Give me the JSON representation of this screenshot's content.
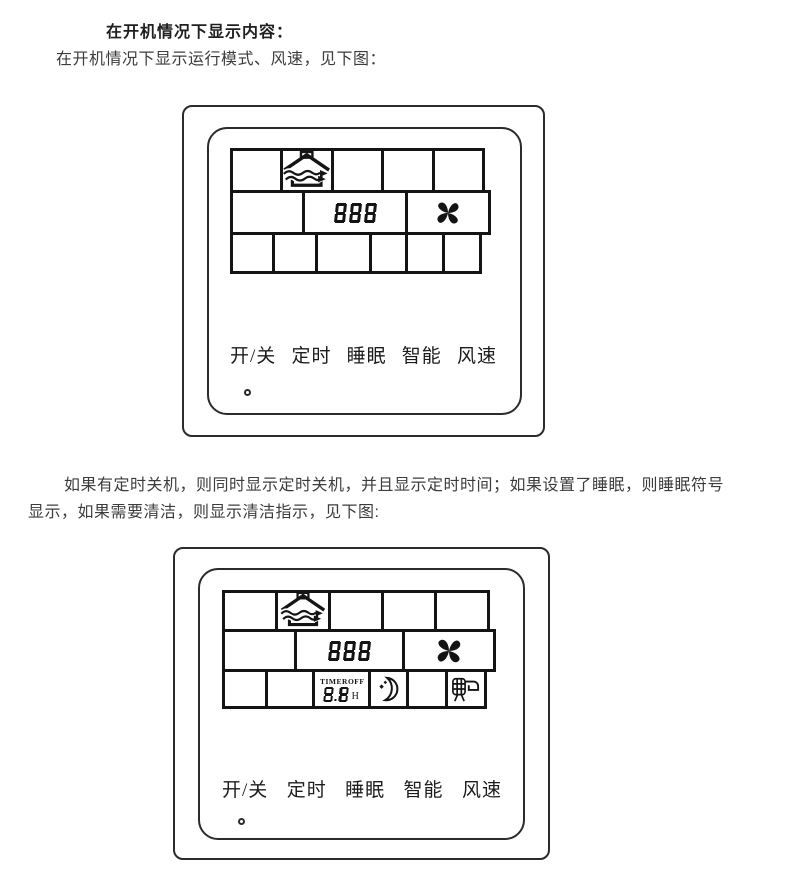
{
  "colors": {
    "ink": "#141414",
    "panel_border": "#2b2b2b",
    "text": "#3c3c3c",
    "bg": "#ffffff"
  },
  "header": {
    "title": "在开机情况下显示内容：",
    "subtitle": "在开机情况下显示运行模式、风速，见下图："
  },
  "paragraph": {
    "line1": "如果有定时关机，则同时显示定时关机，并且显示定时时间；如果设置了睡眠，则睡眠符号",
    "line2": "显示，如果需要清洁，则显示清洁指示，见下图:"
  },
  "panel_on": {
    "mode_icon": "house-airflow-icon",
    "temp_display": "888",
    "fan_icon": "fan-icon",
    "buttons": [
      "开/关",
      "定时",
      "睡眠",
      "智能",
      "风速"
    ]
  },
  "panel_timer": {
    "mode_icon": "house-airflow-icon",
    "temp_display": "888",
    "fan_icon": "fan-icon",
    "timer_label": "TIMER",
    "timer_off_label": "OFF",
    "timer_value": "8.8",
    "timer_unit": "H",
    "sleep_icon": "moon-sleep-icon",
    "clean_icon": "clean-filter-icon",
    "buttons": [
      "开/关",
      "定时",
      "睡眠",
      "智能",
      "风速"
    ]
  }
}
